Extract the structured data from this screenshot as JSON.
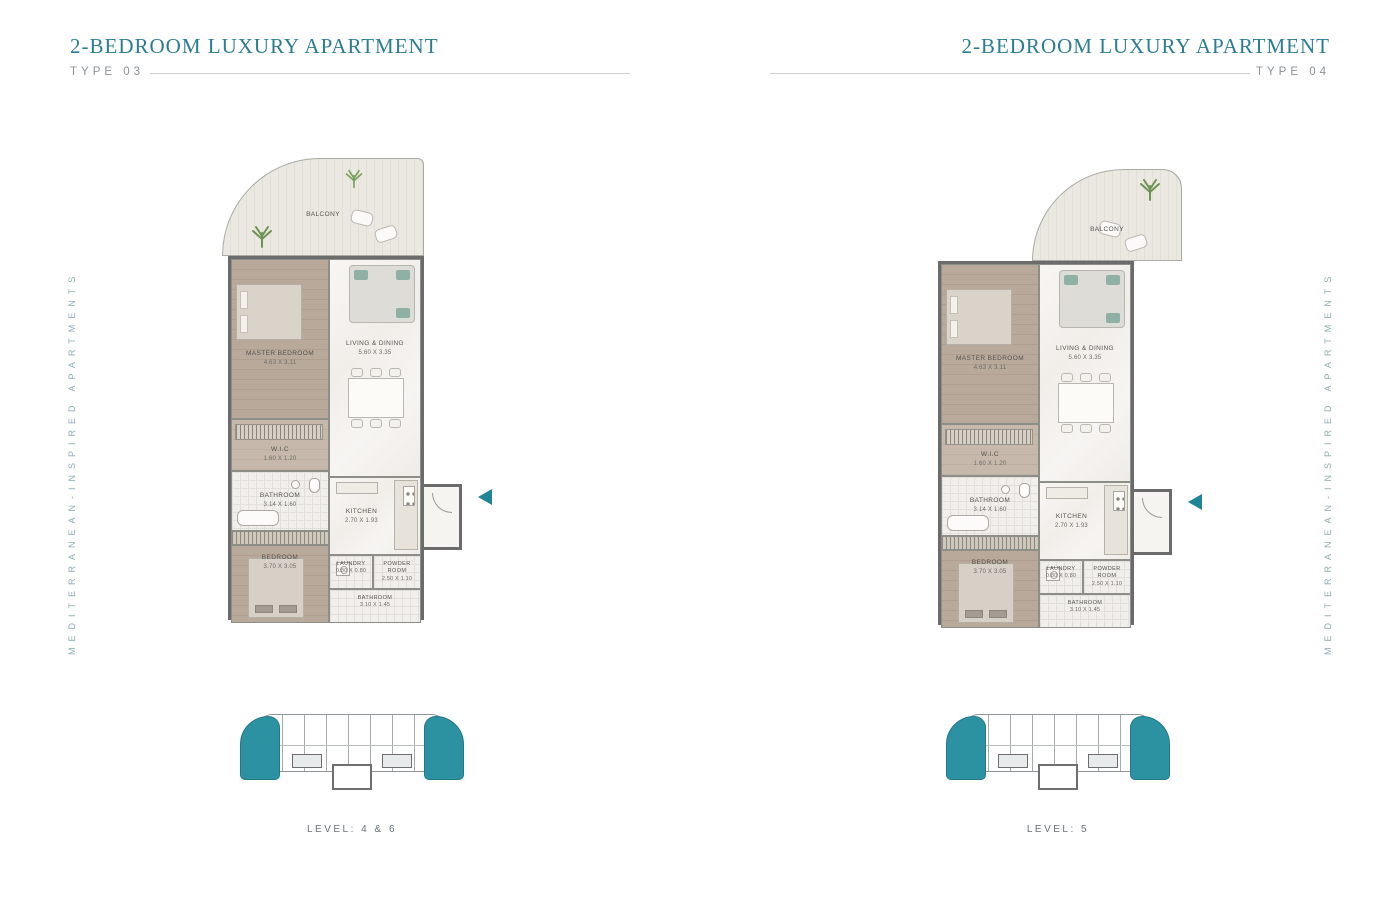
{
  "side_text": "MEDITERRANEAN-INSPIRED APARTMENTS",
  "colors": {
    "accent_teal": "#2b7e92",
    "keyplan_unit_teal": "#2c92a2",
    "entrance_arrow_teal": "#1f8496"
  },
  "plans": [
    {
      "title": "2-BEDROOM LUXURY APARTMENT",
      "type_label": "TYPE 03",
      "level_label": "LEVEL: 4 & 6",
      "rooms": {
        "balcony": {
          "name": "BALCONY"
        },
        "master_bedroom": {
          "name": "MASTER BEDROOM",
          "dims": "4.63 X 3.11"
        },
        "living_dining": {
          "name": "LIVING & DINING",
          "dims": "5.60 X 3.35"
        },
        "wic": {
          "name": "W.I.C",
          "dims": "1.60 X 1.20"
        },
        "bathroom": {
          "name": "BATHROOM",
          "dims": "3.14 X 1.60"
        },
        "kitchen": {
          "name": "KITCHEN",
          "dims": "2.70 X 1.93"
        },
        "bedroom": {
          "name": "BEDROOM",
          "dims": "3.70 X 3.05"
        },
        "laundry": {
          "name": "LAUNDRY",
          "dims": "0.80 X 0.80"
        },
        "powder_room": {
          "name": "POWDER ROOM",
          "dims": "2.50 X 1.10"
        },
        "bathroom_2": {
          "name": "BATHROOM",
          "dims": "3.10 X 1.45"
        }
      }
    },
    {
      "title": "2-BEDROOM LUXURY APARTMENT",
      "type_label": "TYPE 04",
      "level_label": "LEVEL: 5",
      "rooms": {
        "balcony": {
          "name": "BALCONY"
        },
        "master_bedroom": {
          "name": "MASTER BEDROOM",
          "dims": "4.63 X 3.11"
        },
        "living_dining": {
          "name": "LIVING & DINING",
          "dims": "5.60 X 3.35"
        },
        "wic": {
          "name": "W.I.C",
          "dims": "1.60 X 1.20"
        },
        "bathroom": {
          "name": "BATHROOM",
          "dims": "3.14 X 1.60"
        },
        "kitchen": {
          "name": "KITCHEN",
          "dims": "2.70 X 1.93"
        },
        "bedroom": {
          "name": "BEDROOM",
          "dims": "3.70 X 3.05"
        },
        "laundry": {
          "name": "LAUNDRY",
          "dims": "0.80 X 0.80"
        },
        "powder_room": {
          "name": "POWDER ROOM",
          "dims": "2.50 X 1.10"
        },
        "bathroom_2": {
          "name": "BATHROOM",
          "dims": "3.10 X 1.45"
        }
      }
    }
  ]
}
